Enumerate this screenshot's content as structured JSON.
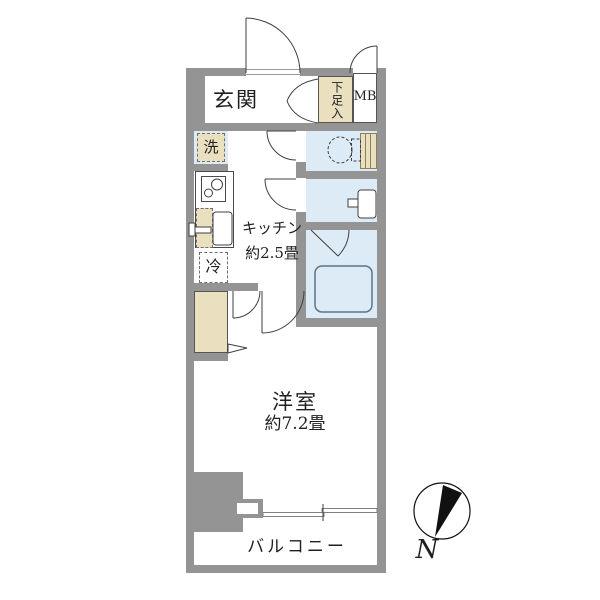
{
  "plan": {
    "title": "apartment-floor-plan",
    "labels": {
      "entrance": "玄関",
      "shoe_storage": "下足入",
      "meter_box": "MB",
      "washer": "洗",
      "refrigerator": "冷",
      "kitchen_name": "キッチン",
      "kitchen_size": "約2.5畳",
      "room_name": "洋室",
      "room_size": "約7.2畳",
      "balcony": "バルコニー",
      "compass_north": "N"
    },
    "colors": {
      "wall": "#949494",
      "wet_room": "#dcebf6",
      "storage": "#eadfbe",
      "outline": "#3f3f3f",
      "text": "#1f1f1f"
    }
  }
}
